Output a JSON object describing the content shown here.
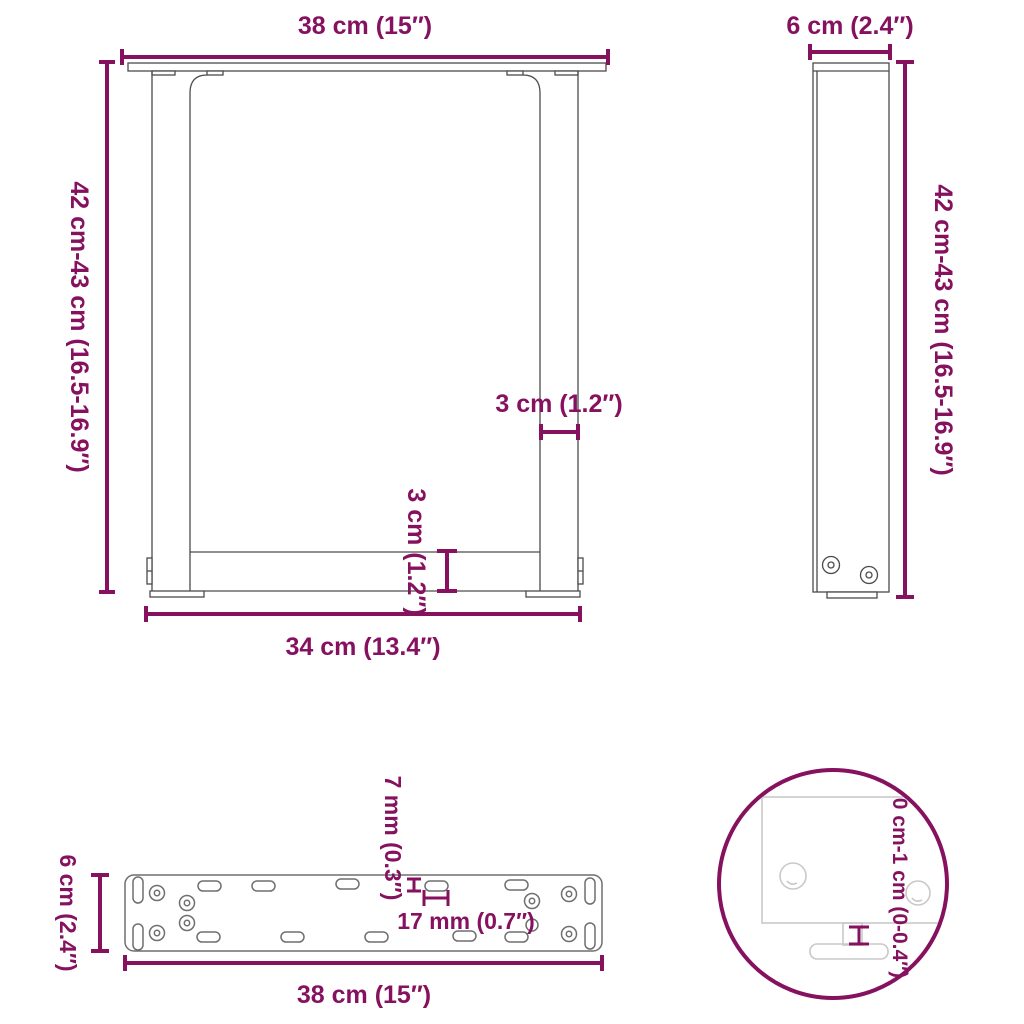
{
  "accent_color": "#85115f",
  "front_view": {
    "description": "U-shaped table leg, front elevation",
    "top_width_label": "38 cm (15″)",
    "height_label": "42 cm-43 cm (16.5-16.9″)",
    "leg_thickness_label": "3 cm (1.2″)",
    "crossbar_thickness_label": "3 cm (1.2″)",
    "bottom_width_label": "34 cm (13.4″)"
  },
  "side_view": {
    "description": "Table leg, side elevation",
    "depth_label": "6 cm (2.4″)",
    "height_label": "42 cm-43 cm (16.5-16.9″)"
  },
  "plate_view": {
    "description": "Mounting plate, top view",
    "depth_label": "6 cm (2.4″)",
    "slot_width_label": "7 mm (0.3″)",
    "slot_length_label": "17 mm (0.7″)",
    "width_label": "38 cm (15″)"
  },
  "detail_view": {
    "description": "Adjustable foot detail, magnified",
    "adjustable_range_label": "0 cm-1 cm (0-0.4″)"
  }
}
